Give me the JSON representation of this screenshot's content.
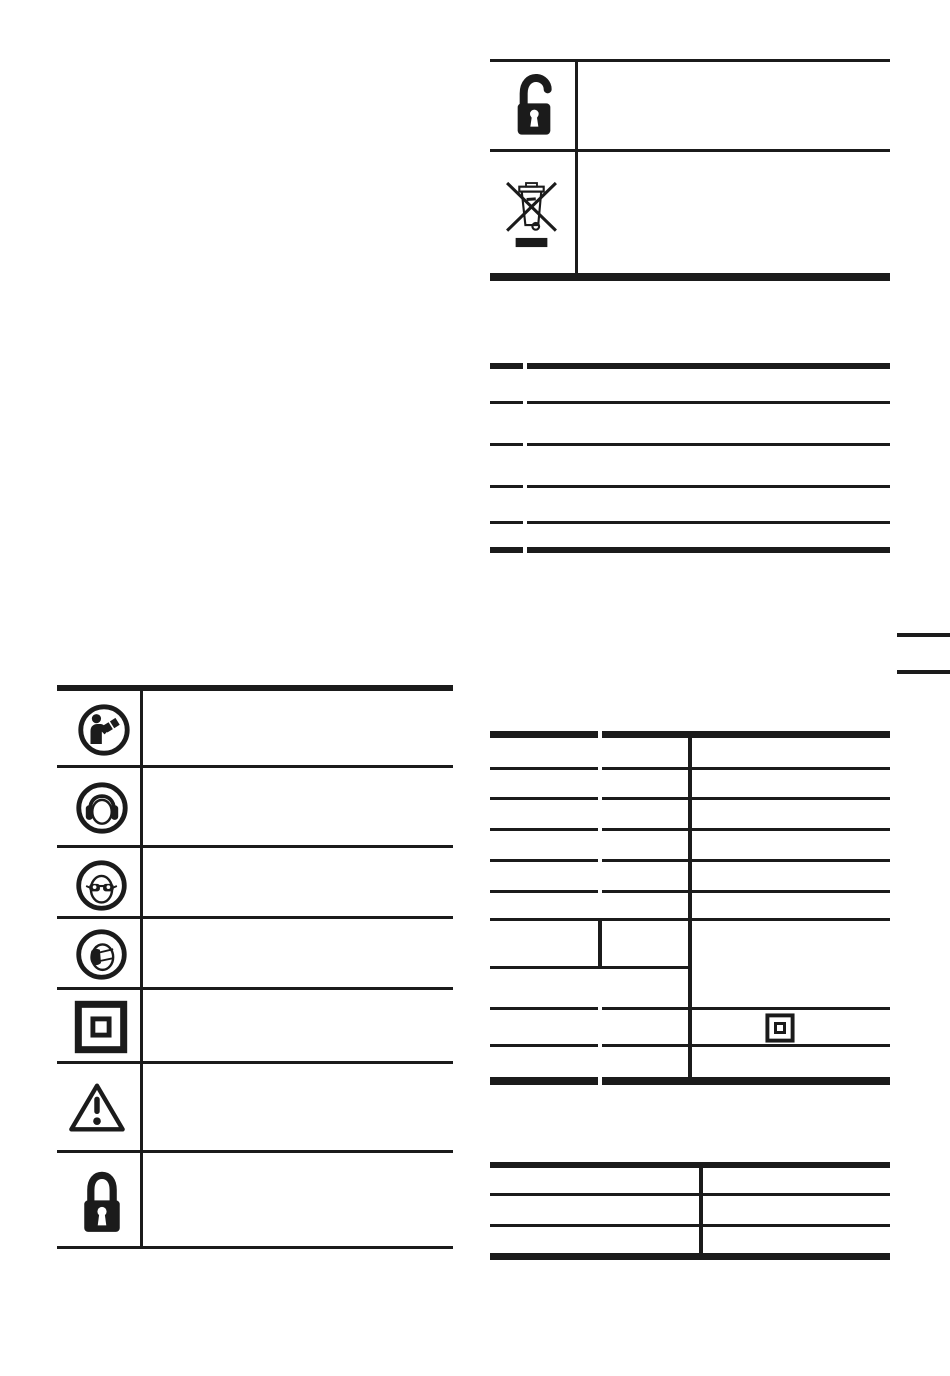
{
  "page": {
    "description": "Instruction-manual page: symbol legend tables and data tables with empty text cells",
    "background": "#ffffff",
    "ink_color": "#1b1b1b"
  },
  "pictogram_table_top_right": {
    "rows": [
      {
        "icon": "padlock-open-icon",
        "label": ""
      },
      {
        "icon": "weee-crossed-bin-icon",
        "label": ""
      }
    ]
  },
  "ratings_table": {
    "row_count": 5,
    "column_count": 2,
    "cell_text": ""
  },
  "safety_symbols_table": {
    "rows": [
      {
        "icon": "read-manual-icon",
        "label": ""
      },
      {
        "icon": "ear-protection-icon",
        "label": ""
      },
      {
        "icon": "eye-protection-icon",
        "label": ""
      },
      {
        "icon": "dust-mask-icon",
        "label": ""
      },
      {
        "icon": "double-insulation-icon",
        "label": ""
      },
      {
        "icon": "warning-icon",
        "label": ""
      },
      {
        "icon": "padlock-closed-icon",
        "label": ""
      }
    ]
  },
  "technical_data_table": {
    "row_count": 10,
    "column_count": 2,
    "split_row_has_subcolumn": true,
    "right_column_icon": "double-insulation-small-icon",
    "cell_text": ""
  },
  "small_table_bottom_right": {
    "row_count": 3,
    "column_count": 2,
    "cell_text": ""
  },
  "page_edge_marks": {
    "count": 2,
    "side": "right"
  }
}
